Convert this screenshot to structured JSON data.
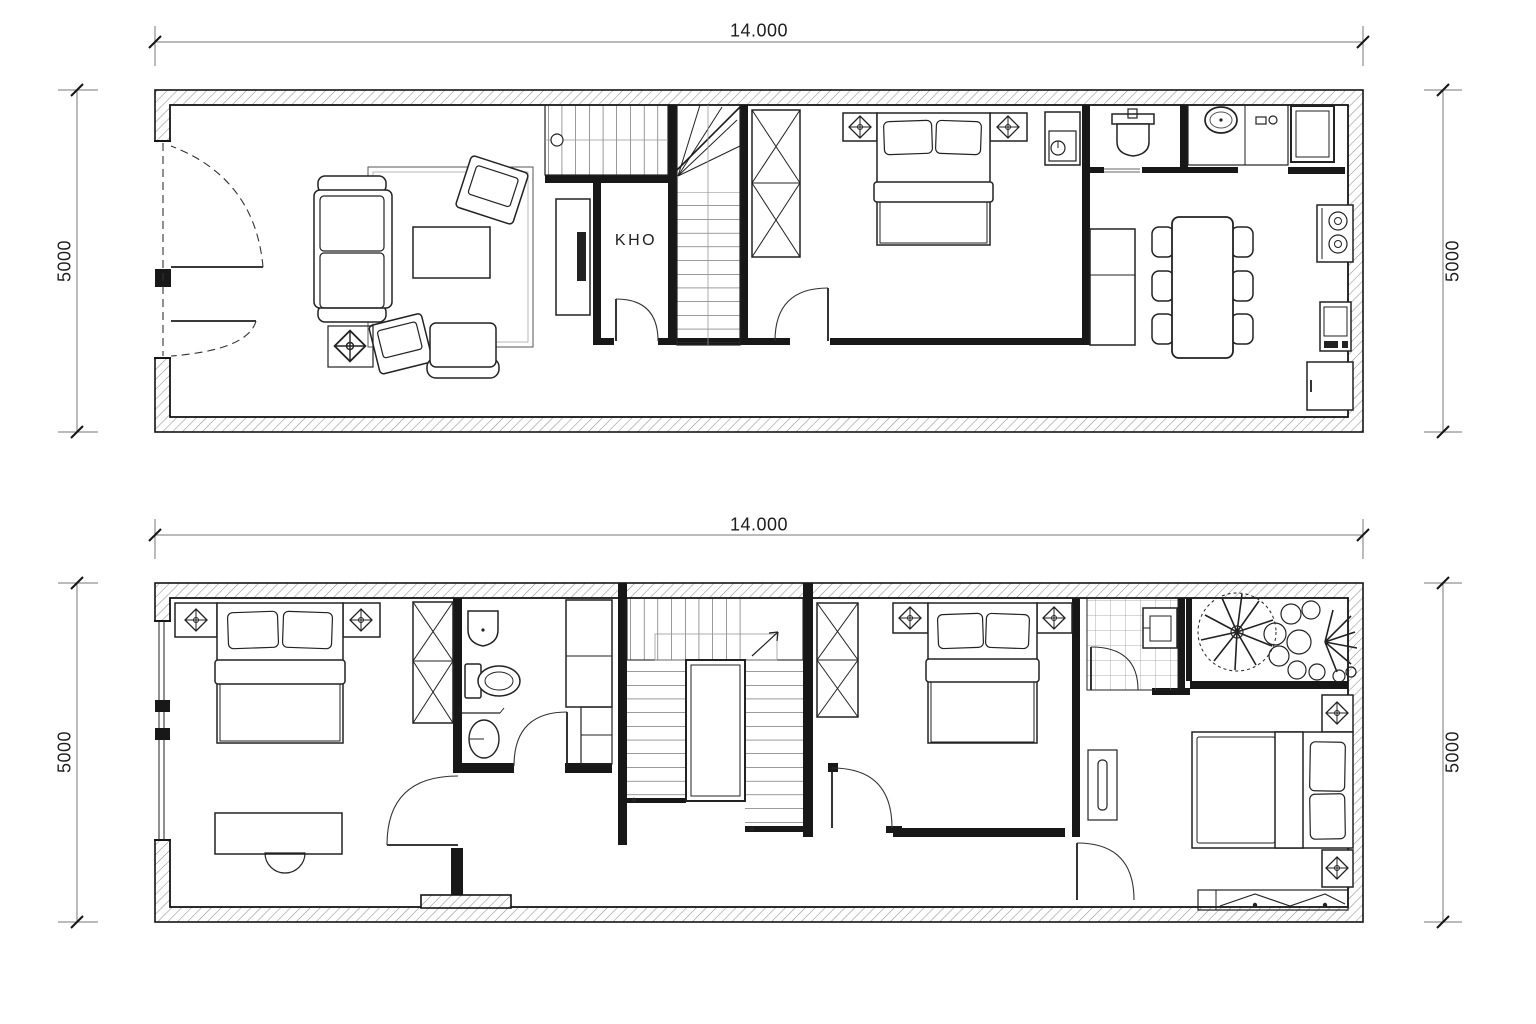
{
  "page": {
    "background": "#ffffff",
    "ink": "#1b1b1b",
    "hatch_color": "#8f8f8f"
  },
  "ground_floor": {
    "dimensions": {
      "width": "14.000",
      "height_left": "5000",
      "height_right": "5000"
    },
    "labels": {
      "storage": "KHO"
    },
    "rooms": [
      "living-room",
      "storage-kho",
      "stair-hall",
      "bedroom",
      "bathroom",
      "kitchen",
      "dining-area"
    ],
    "furniture": [
      "entry-double-door",
      "sofa",
      "armchair",
      "armchair-with-ottoman",
      "coffee-table",
      "rug",
      "floor-lamp-symbol",
      "tv-cabinet",
      "staircase",
      "wardrobe",
      "double-bed",
      "nightstand",
      "ceiling-light-symbol",
      "wall-cabinet",
      "wash-basin",
      "kitchen-counter",
      "kitchen-sink",
      "refrigerator",
      "cooktop",
      "appliance",
      "corner-cabinet",
      "sideboard",
      "dining-table",
      "dining-chairs"
    ]
  },
  "upper_floor": {
    "dimensions": {
      "width": "14.000",
      "height_left": "5000",
      "height_right": "5000"
    },
    "rooms": [
      "bedroom-1",
      "bathroom-1",
      "hallway",
      "staircase",
      "bedroom-2",
      "bathroom-2",
      "balcony",
      "bedroom-3",
      "family-area"
    ],
    "furniture": [
      "window",
      "double-bed",
      "nightstand",
      "ceiling-light-symbol",
      "desk",
      "desk-chair",
      "wardrobe",
      "wash-basin",
      "toilet",
      "laundry-basin",
      "towel-rail",
      "tall-cabinet",
      "staircase",
      "tiled-floor",
      "plants",
      "wall-shelf",
      "low-cabinet"
    ]
  }
}
